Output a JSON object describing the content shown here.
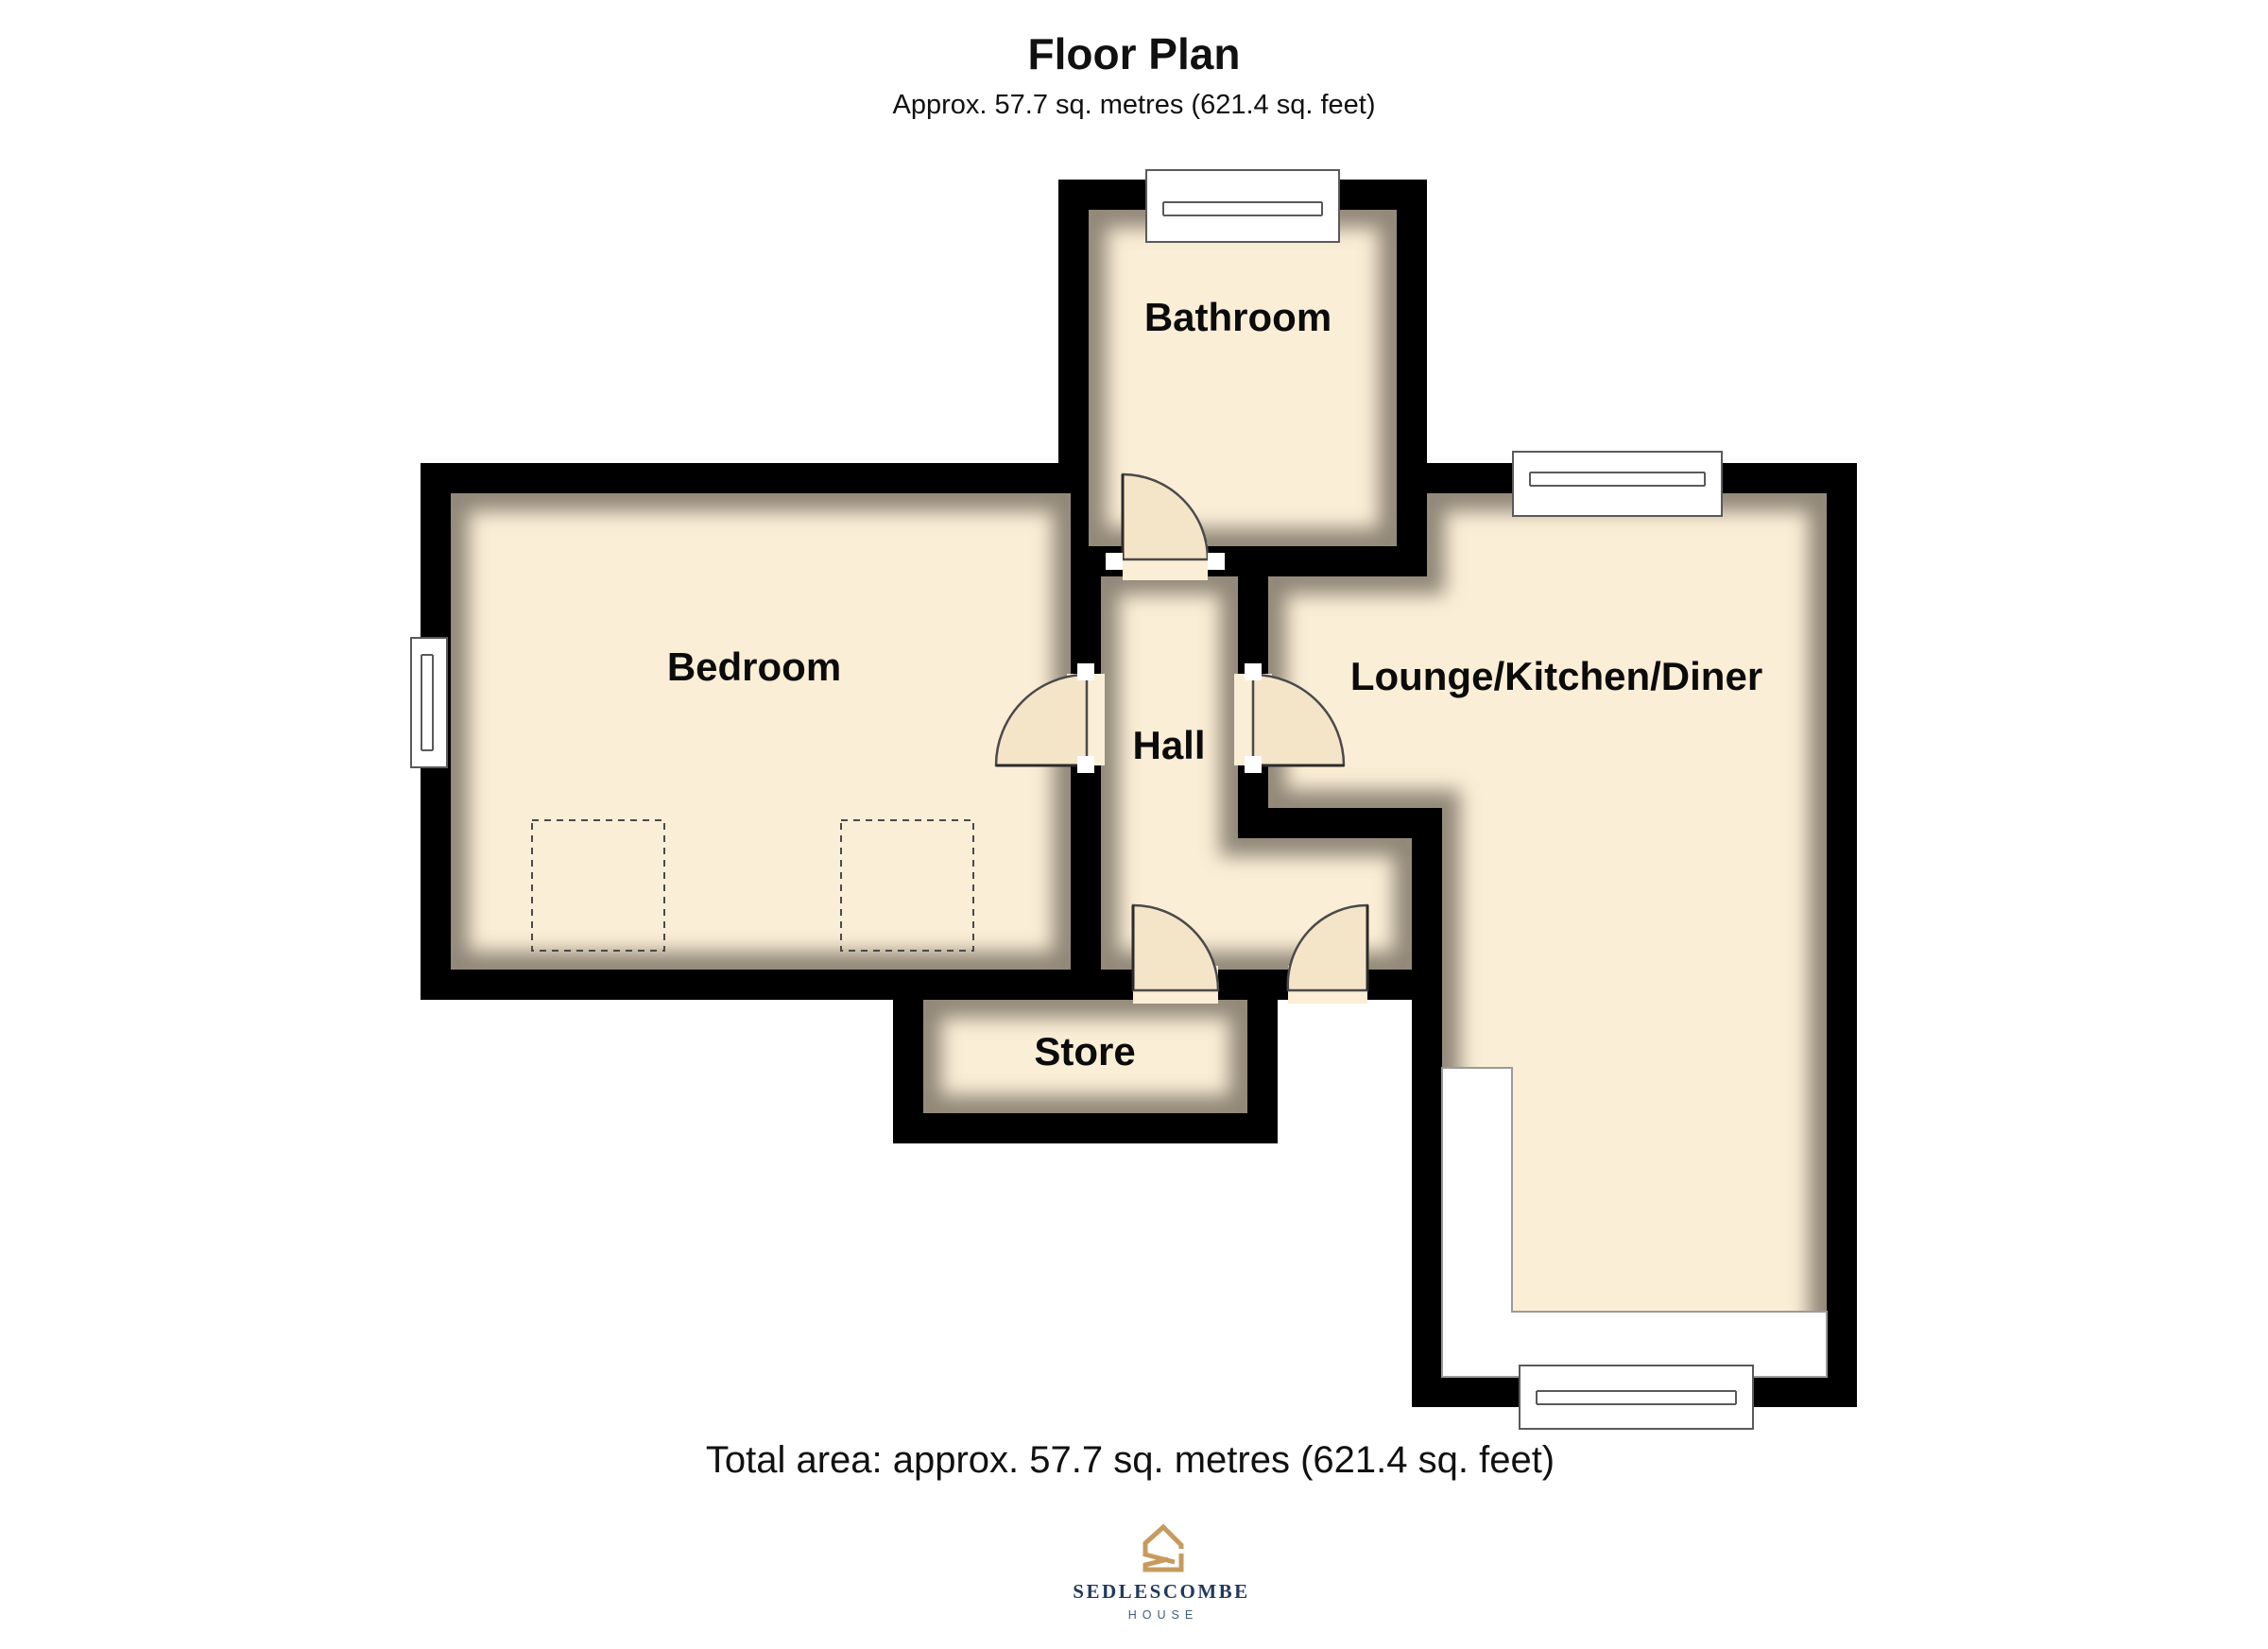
{
  "header": {
    "title": "Floor Plan",
    "subtitle": "Approx. 57.7 sq. metres (621.4 sq. feet)"
  },
  "rooms": {
    "bathroom": {
      "label": "Bathroom"
    },
    "bedroom": {
      "label": "Bedroom"
    },
    "hall": {
      "label": "Hall"
    },
    "lounge_kitchen_diner": {
      "label": "Lounge/Kitchen/Diner"
    },
    "store": {
      "label": "Store"
    }
  },
  "footer": {
    "total_area": "Total area: approx. 57.7 sq. metres (621.4 sq. feet)"
  },
  "branding": {
    "name": "SEDLESCOMBE",
    "tagline": "HOUSE",
    "accent_color": "#C69B5E",
    "name_color": "#203A5C",
    "tagline_color": "#3F5E7E"
  },
  "palette": {
    "wall": "#000000",
    "floor": "#FBEED6",
    "background": "#FFFFFF",
    "door_outline": "#4A4A4A"
  }
}
